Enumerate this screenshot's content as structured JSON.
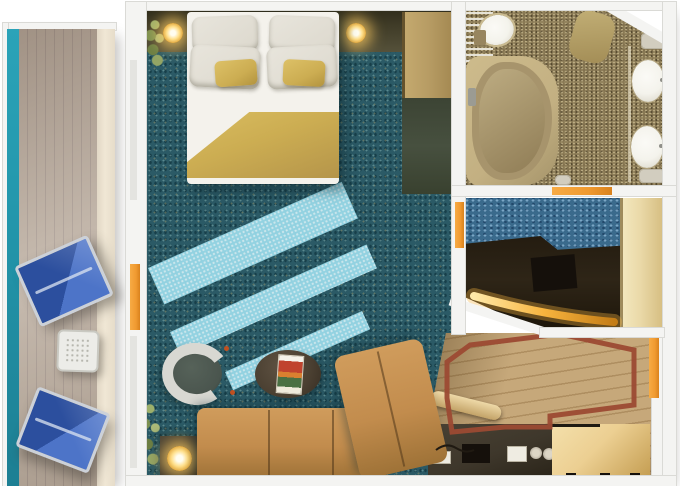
{
  "meta": {
    "title": "Cruise-ship suite floor plan, top-down 3D render",
    "image_type": "floor-plan rendering",
    "canvas": {
      "width": 680,
      "height": 486
    },
    "text_visible": "none"
  },
  "palette": {
    "wall": "#f4f4f2",
    "wallEdge": "#dadad6",
    "door": "#f09a30",
    "ocean": "#2397ac",
    "deck": "#b7a899",
    "deckLine": "#a3948a",
    "deckLight": "#f0e7d5",
    "frame": "#ccd1d8",
    "blueDark": "#2c4f9e",
    "blueLight": "#4d74c8",
    "tableWhite": "#ecece8",
    "carpet": "#2b5a66",
    "sun": "#9bdceb",
    "headboard": "#3e3a26",
    "wardrobe": "#b79c64",
    "darkzone": "#47503f",
    "sheet": "#f4f2ec",
    "pillow": "#dcd8cd",
    "gold": "#ccad52",
    "sofa": "#c28c4d",
    "sofaDark": "#9e7237",
    "lampGlow": "#ffd36e",
    "tableDark": "#39332a",
    "chairShell": "#d8d8d2",
    "chairSeat": "#4a554e",
    "coffee": "#4a3f31",
    "bath": "#82724f",
    "tubRim": "#c3b082",
    "tubFill": "#a7946c",
    "porcelain": "#f4f3ec",
    "mosaic": "#3a6a8c",
    "vanity": "#2e2517",
    "closet": "#ead9a8",
    "wood": "#c6a87a",
    "woodLine": "#ae8e60",
    "rug": "#9c4a33",
    "cabinet": "#eccf92",
    "cabinetDeep": "#c49d51",
    "counter": "#3e372b"
  },
  "rooms": {
    "balcony": {
      "items": [
        "lounge-chair",
        "lounge-chair",
        "mesh-side-table",
        "wood-deck",
        "ocean-edge"
      ]
    },
    "bedroom_living": {
      "items": [
        "double-bed",
        "white-pillows-x4",
        "gold-accent-pillows-x2",
        "gold-blanket",
        "wall-lamp-left",
        "wall-lamp-right",
        "headboard-shelf",
        "plant-top",
        "wardrobe",
        "sunlight-stripes",
        "tub-armchair",
        "round-coffee-table",
        "magazine",
        "plant-bottom",
        "lamp-side-table",
        "sectional-sofa",
        "chaise-section"
      ]
    },
    "bathroom": {
      "items": [
        "bathtub",
        "toilet",
        "shower-screen",
        "bath-mat",
        "sink",
        "sink",
        "towel-shelf"
      ]
    },
    "dressing_vanity": {
      "items": [
        "mosaic-carpet",
        "vanity-counter-with-lit-edge",
        "stool",
        "closet-band"
      ]
    },
    "entry_hall": {
      "items": [
        "inlaid-wood-floor",
        "red-border-inlay",
        "minibar-counter",
        "counter-items",
        "cabinet"
      ]
    }
  },
  "door_markers": [
    {
      "name": "balcony-door",
      "side": "left-wall"
    },
    {
      "name": "dressing-area-door",
      "side": "bedroom-divider-wall"
    },
    {
      "name": "bathroom-door",
      "side": "bathroom-bottom-wall"
    },
    {
      "name": "cabin-entry-door",
      "side": "right-wall"
    }
  ]
}
